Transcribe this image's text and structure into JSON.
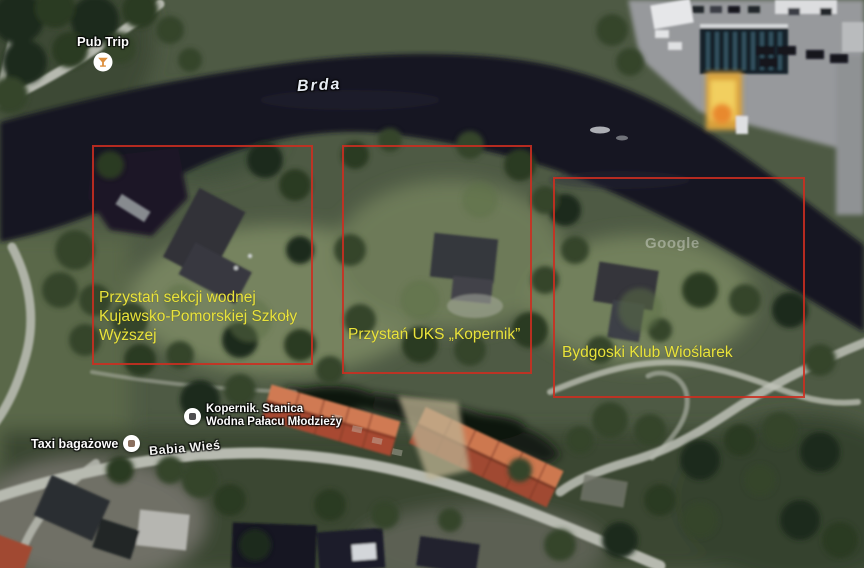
{
  "map": {
    "river_label": "Brda",
    "street_label": "Babia Wieś",
    "watermark": "Google",
    "pois": {
      "pub": {
        "label": "Pub Trip",
        "icon": "cocktail-glass"
      },
      "kopernik": {
        "label_line1": "Kopernik. Stanica",
        "label_line2": "Wodna Pałacu Młodzieży",
        "icon": "generic-place-square"
      },
      "taxi": {
        "label": "Taxi bagażowe",
        "icon": "generic-place-square"
      }
    },
    "annotations": {
      "box1": {
        "label": "Przystań sekcji wodnej Kujawsko-Pomorskiej Szkoły Wyższej"
      },
      "box2": {
        "label": "Przystań UKS „Kopernik”"
      },
      "box3": {
        "label": "Bydgoski Klub Wioślarek"
      }
    },
    "colors": {
      "annotation_border": "#cc2d20",
      "annotation_text": "#e9e43c",
      "water": "#191623",
      "poi_pub_glass": "#dd8f3d"
    }
  }
}
